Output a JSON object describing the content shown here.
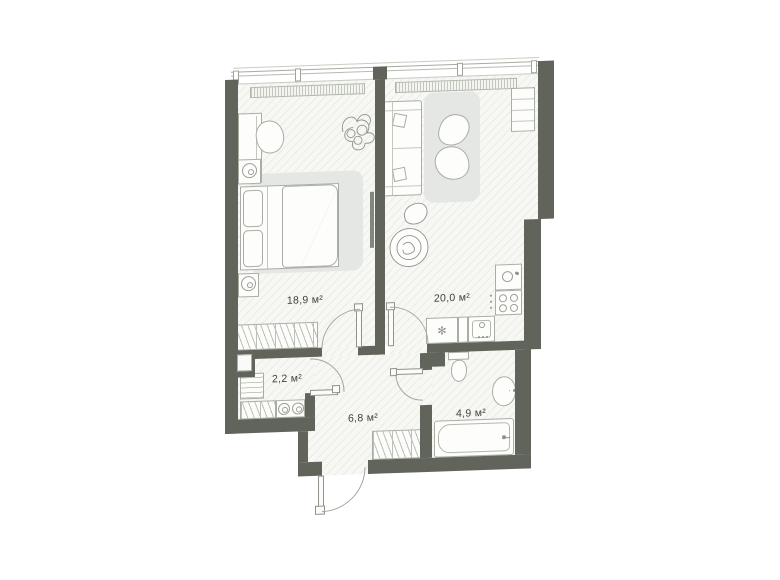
{
  "plan": {
    "type": "apartment-floor-plan",
    "rooms": [
      {
        "id": "bedroom",
        "area_label": "18,9 м²"
      },
      {
        "id": "living-kitchen",
        "area_label": "20,0 м²"
      },
      {
        "id": "storage",
        "area_label": "2,2 м²"
      },
      {
        "id": "hallway",
        "area_label": "6,8 м²"
      },
      {
        "id": "bathroom",
        "area_label": "4,9 м²"
      }
    ],
    "icons": {
      "fridge_snowflake": "✻"
    },
    "colors": {
      "wall": "#60645a",
      "floor": "#f7f7f4",
      "furniture_outline": "#a9aea5",
      "rug": "#e4e7e3",
      "label_text": "#3e4338",
      "background": "#ffffff"
    }
  }
}
